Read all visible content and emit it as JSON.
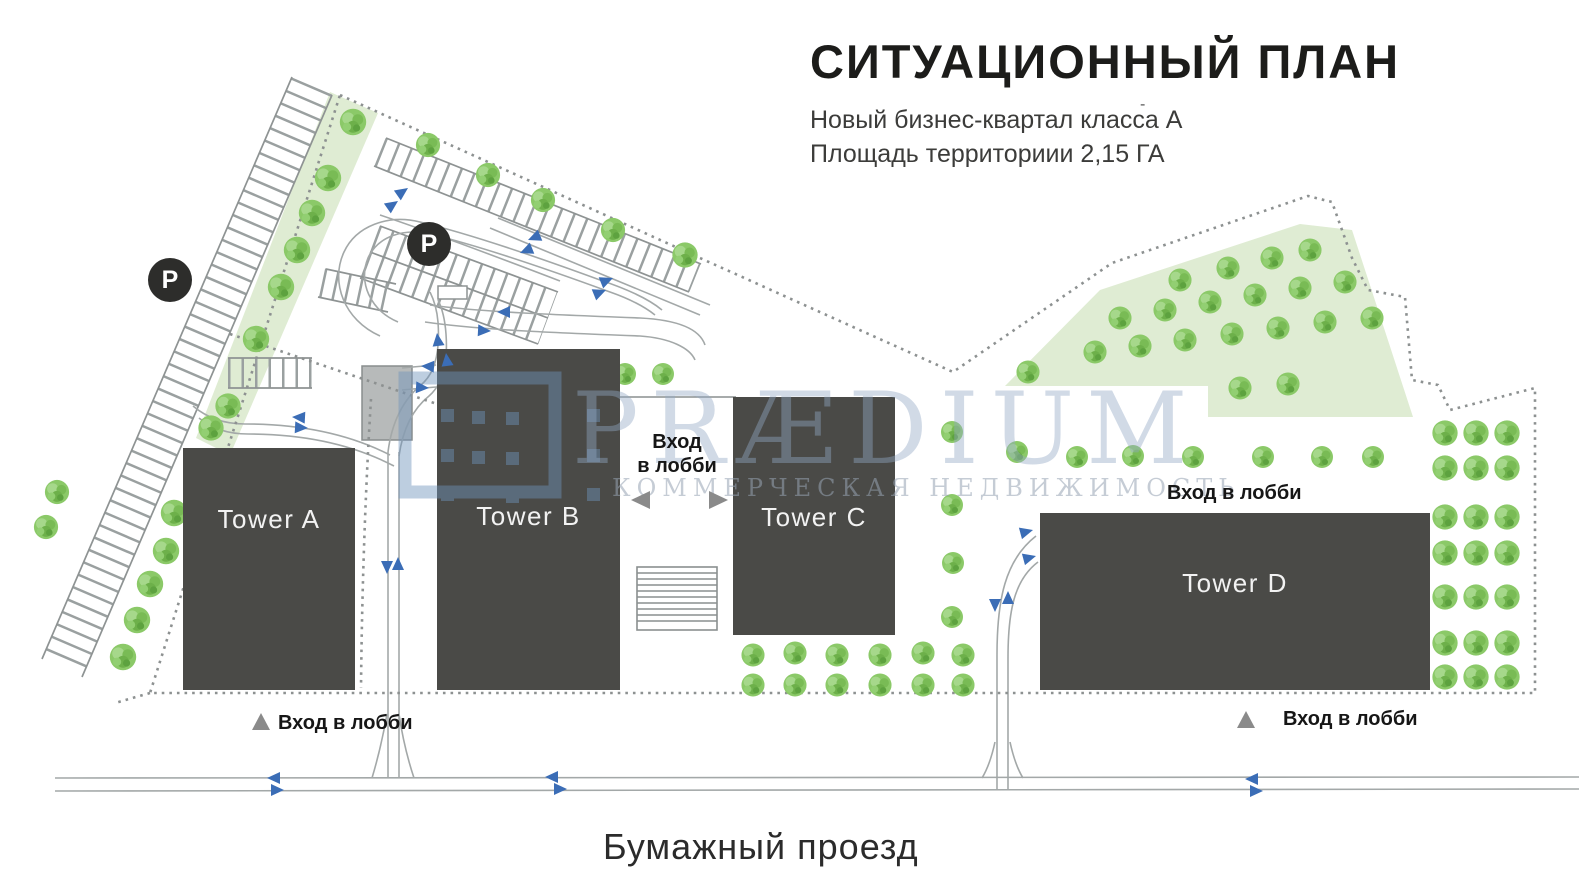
{
  "header": {
    "title": "СИТУАЦИОННЫЙ ПЛАН",
    "subtitle_line1": "Новый бизнес-квартал класса А",
    "subtitle_line2": "Площадь территориии 2,15 ГА",
    "footnote_mark": "-"
  },
  "plan": {
    "towers": [
      {
        "label": "Tower A"
      },
      {
        "label": "Tower B"
      },
      {
        "label": "Tower C"
      },
      {
        "label": "Tower D"
      }
    ],
    "entrances": {
      "between_b_c": {
        "line1": "Вход",
        "line2": "в лобби"
      },
      "tower_d_top": "Вход в лобби",
      "below_tower_a": "Вход в лобби",
      "bottom_right": "Вход в лобби"
    },
    "parking_marker": "P",
    "street_name": "Бумажный проезд"
  },
  "watermark": {
    "brand": "PRÆDIUM",
    "tagline": "КОММЕРЧЕСКАЯ НЕДВИЖИМОСТЬ"
  },
  "colors": {
    "building": "#4a4a47",
    "building_text": "#f2f2f2",
    "green_area": "#dfecd3",
    "tree": "#8bc968",
    "road": "#a3a8a8",
    "boundary": "#8d9191",
    "arrow_blue": "#3b6db6",
    "arrow_gray": "#8a8a8a",
    "parking_badge": "#2d2d2b",
    "title_text": "#1c1c1a"
  }
}
